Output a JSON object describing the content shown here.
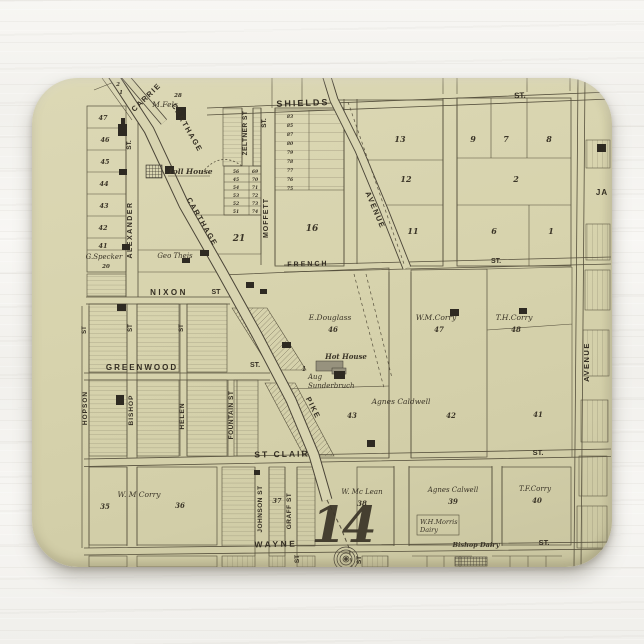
{
  "scene": {
    "description": "Vintage plat map mousepad on white painted wood",
    "wood_color": "#f6f5f2",
    "pad_color": "#d7d3ad",
    "ink_color": "#332d22",
    "line_color": "#56503d"
  },
  "streets": {
    "shields": "SHIELDS",
    "shields_st": "ST.",
    "french": "FRENCH",
    "french_st": "ST.",
    "nixon": "NIXON",
    "nixon_st": "ST",
    "greenwood": "GREENWOOD",
    "greenwood_st": "ST.",
    "st_clair": "ST CLAIR",
    "st_clair_right": "ST.",
    "wayne": "WAYNE",
    "wayne_right": "ST.",
    "carrie": "CARRIE",
    "carthage_upper": "CARTHAGE",
    "carthage_lower": "CARTHAGE",
    "pike": "PIKE",
    "avenue_diagonal": "AVENUE",
    "avenue_right": "AVENUE",
    "ja": "JA",
    "alexander": "ALEXANDER",
    "alexander_st": "ST.",
    "zeltner": "ZELTNER ST",
    "moffett": "MOFFETT",
    "moffett_st": "ST.",
    "hopson": "HOPSON",
    "hopson_st": "ST",
    "bishop": "BISHOP",
    "bishop_st": "ST",
    "helen": "HELEN",
    "helen_st": "ST",
    "fountain": "FOUNTAIN ST",
    "johnson": "JOHNSON ST",
    "graff": "GRAFF ST",
    "stub_st_1": "ST",
    "stub_st_2": "ST"
  },
  "owners": {
    "m_fels": "M.Fels",
    "m_fels_lot": "28",
    "toll_house": "Toll House",
    "g_specker": "G.Specker",
    "g_specker_lot": "20",
    "geo_theis": "Geo Theis",
    "e_douglass": "E.Douglass",
    "e_douglass_lot": "46",
    "wm_corry": "W.M.Corry",
    "wm_corry_lot": "47",
    "th_corry": "T.H.Corry",
    "th_corry_lot": "48",
    "hot_house": "Hot House",
    "aug_line1": "Aug",
    "aug_line2": "Sunderbruch",
    "agnes_mid": "Agnes Caldwell",
    "lot43": "43",
    "lot42": "42",
    "lot41": "41",
    "wm_corry_sw": "W. M Corry",
    "lot35": "35",
    "lot36": "36",
    "lot37": "37",
    "w_mclean": "W. Mc Lean",
    "lot38": "38",
    "agnes_sw": "Agnes Calwell",
    "lot39": "39",
    "tf_corry": "T.F.Corry",
    "lot40": "40",
    "wh_morris_line1": "W.H.Morris",
    "wh_morris_line2": "Dairy",
    "bishop_dairy": "Bishop Dairy",
    "misc_1": "1"
  },
  "blocks": {
    "plate_number": "14",
    "wedge": "21",
    "lot16": "16",
    "b13": "13",
    "b12": "12",
    "b11": "11",
    "b9": "9",
    "b7": "7",
    "b8": "8",
    "b2": "2",
    "b6": "6",
    "b1": "1",
    "left_lots": [
      "47",
      "46",
      "45",
      "44",
      "43",
      "42",
      "41"
    ],
    "top_lots": [
      "2",
      "1"
    ],
    "strip_left": [
      "56",
      "45",
      "54",
      "53",
      "52",
      "51"
    ],
    "strip_right": [
      "69",
      "70",
      "71",
      "72",
      "73",
      "74"
    ],
    "moffett_rows": [
      "83",
      "85",
      "87",
      "80",
      "79",
      "78",
      "77",
      "76",
      "75"
    ]
  }
}
